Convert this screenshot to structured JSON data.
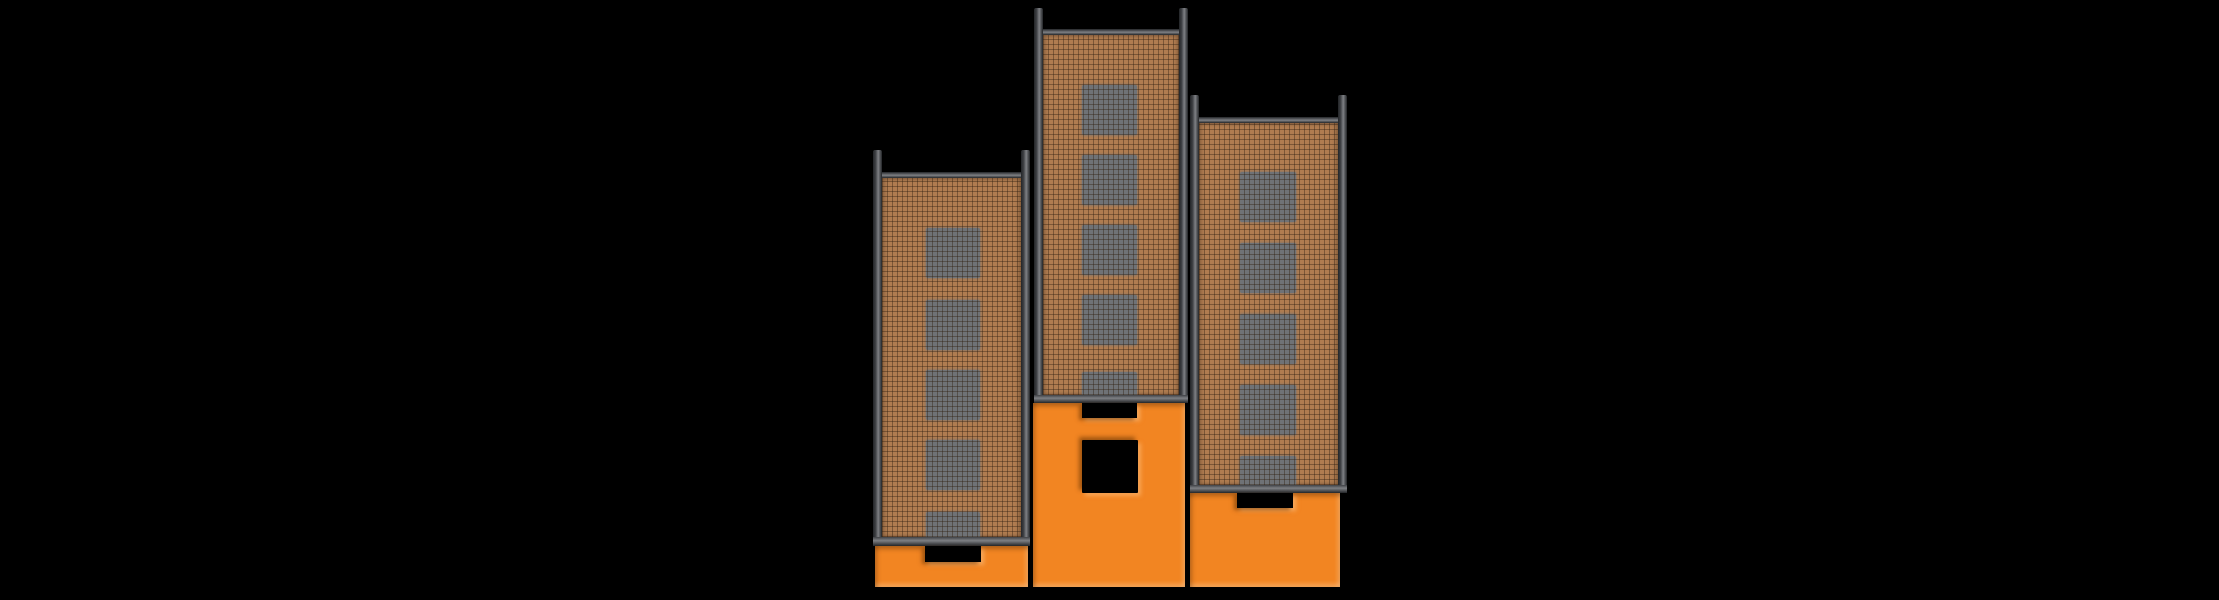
{
  "scene": {
    "description": "Illustration of three brick high-rise towers with rooftop corner posts, gray windows and orange entrance blocks with black door openings, on a black background",
    "canvas": {
      "width": 2219,
      "height": 600
    }
  },
  "palette": {
    "background": "#000000",
    "brick": "#b07c50",
    "brick_grid_line": "rgba(45,28,14,0.40)",
    "window_gray": "#6f7276",
    "frame_dark": "#232528",
    "frame_mid": "#3f4145",
    "frame_light": "#7e8084",
    "base_orange": "#f28522",
    "opening_black": "#000000"
  },
  "buildings": [
    {
      "id": "left-tower",
      "x": 873,
      "width": 157,
      "post_top_y": 150,
      "roof_band_y": 172,
      "brick_top_y": 178,
      "brick_bottom_y": 537,
      "bottom_band_height": 9,
      "frame_thickness": 9,
      "windows": {
        "x": 926,
        "width": 54,
        "height": 50,
        "tops_y": [
          228,
          300,
          370,
          440,
          512
        ]
      },
      "base": {
        "x": 875,
        "y": 546,
        "width": 153,
        "height": 41,
        "notch": {
          "x": 925,
          "width": 56,
          "depth": 16
        },
        "door_window": null
      }
    },
    {
      "id": "middle-tower",
      "x": 1034,
      "width": 154,
      "post_top_y": 8,
      "roof_band_y": 29,
      "brick_top_y": 35,
      "brick_bottom_y": 395,
      "bottom_band_height": 8,
      "frame_thickness": 9,
      "windows": {
        "x": 1082,
        "width": 55,
        "height": 50,
        "tops_y": [
          85,
          155,
          225,
          295,
          372
        ]
      },
      "base": {
        "x": 1033,
        "y": 403,
        "width": 152,
        "height": 184,
        "notch": {
          "x": 1082,
          "width": 55,
          "depth": 15
        },
        "door_window": {
          "x": 1082,
          "y": 440,
          "width": 56,
          "height": 53
        }
      }
    },
    {
      "id": "right-tower",
      "x": 1190,
      "width": 157,
      "post_top_y": 95,
      "roof_band_y": 117,
      "brick_top_y": 123,
      "brick_bottom_y": 485,
      "bottom_band_height": 8,
      "frame_thickness": 9,
      "windows": {
        "x": 1240,
        "width": 56,
        "height": 50,
        "tops_y": [
          172,
          243,
          314,
          385,
          456
        ]
      },
      "base": {
        "x": 1190,
        "y": 493,
        "width": 150,
        "height": 94,
        "notch": {
          "x": 1237,
          "width": 56,
          "depth": 15
        },
        "door_window": null
      }
    }
  ]
}
